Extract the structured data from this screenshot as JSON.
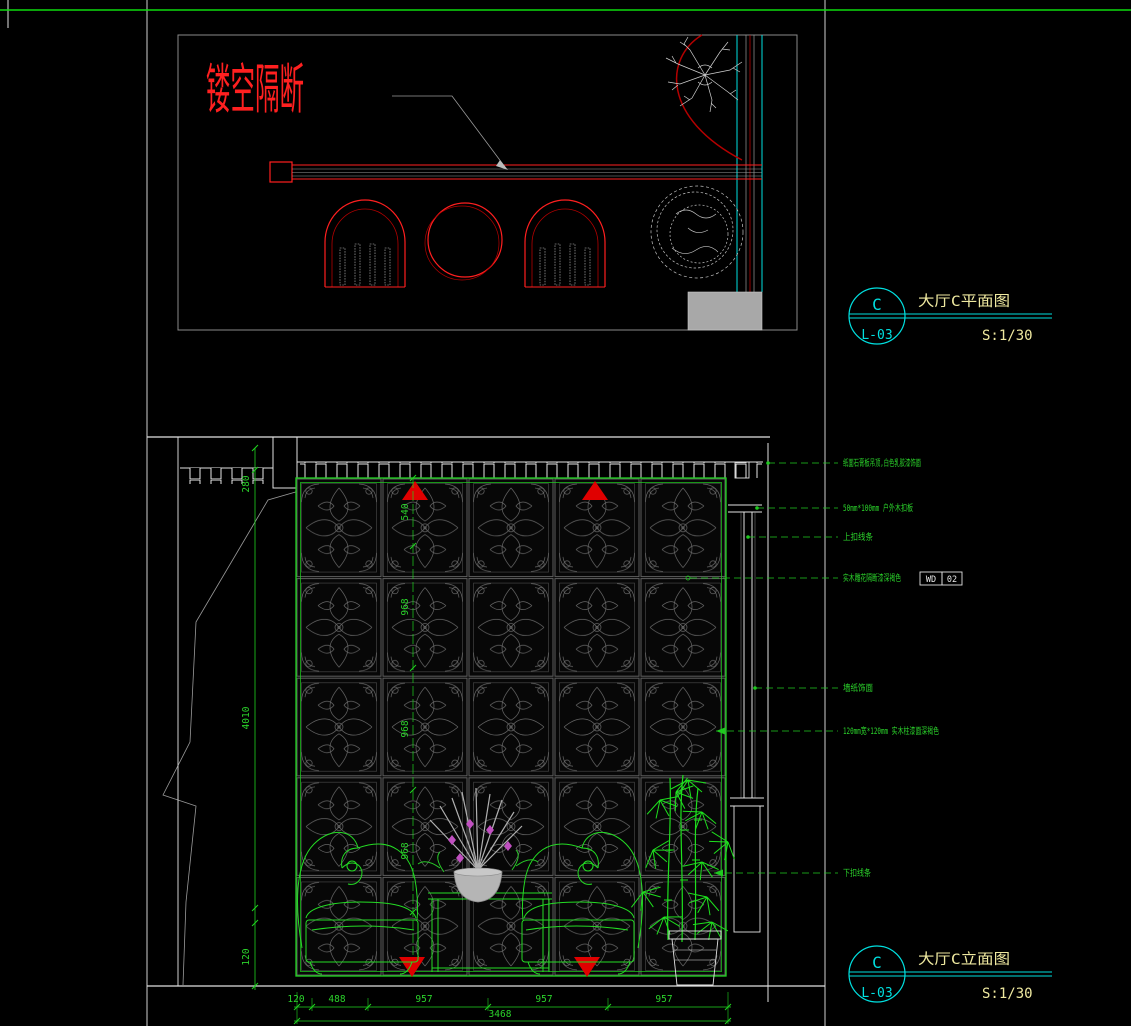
{
  "sheet": {
    "colors": {
      "background": "#000000",
      "line_white": "#e2e2e2",
      "line_gray": "#9a9a9a",
      "red": "#ff1f1f",
      "dark_red": "#b40000",
      "green": "#1fd41f",
      "cyan": "#00e0e0",
      "title_yellow": "#efe9a0",
      "magenta": "#c050c0",
      "column_fill": "#a8a8a8"
    }
  },
  "plan_view": {
    "label": "镂空隔断",
    "callout": {
      "letter": "C",
      "sheet_no": "L-03",
      "title": "大厅C平面图",
      "scale": "S:1/30"
    }
  },
  "elevation_view": {
    "callout": {
      "letter": "C",
      "sheet_no": "L-03",
      "title": "大厅C立面图",
      "scale": "S:1/30"
    },
    "material_tag": {
      "code": "WD",
      "number": "02"
    },
    "annotations": [
      {
        "text": "纸面石膏板吊顶,白色乳胶漆饰面"
      },
      {
        "text": "50mm*100mm 户外木扣板"
      },
      {
        "text": "上扣线条"
      },
      {
        "text": "实木雕花隔断漆深褐色"
      },
      {
        "text": "墙纸饰面"
      },
      {
        "text": "120mm宽*120mm 实木柱漆面深褐色"
      },
      {
        "text": "下扣线条"
      }
    ],
    "dimensions": {
      "left": [
        "280",
        "4010",
        "120"
      ],
      "lattice_chain": [
        "540",
        "968",
        "968",
        "968"
      ],
      "bottom": [
        "120",
        "488",
        "957",
        "957",
        "957"
      ],
      "bottom_total": "3468"
    }
  }
}
